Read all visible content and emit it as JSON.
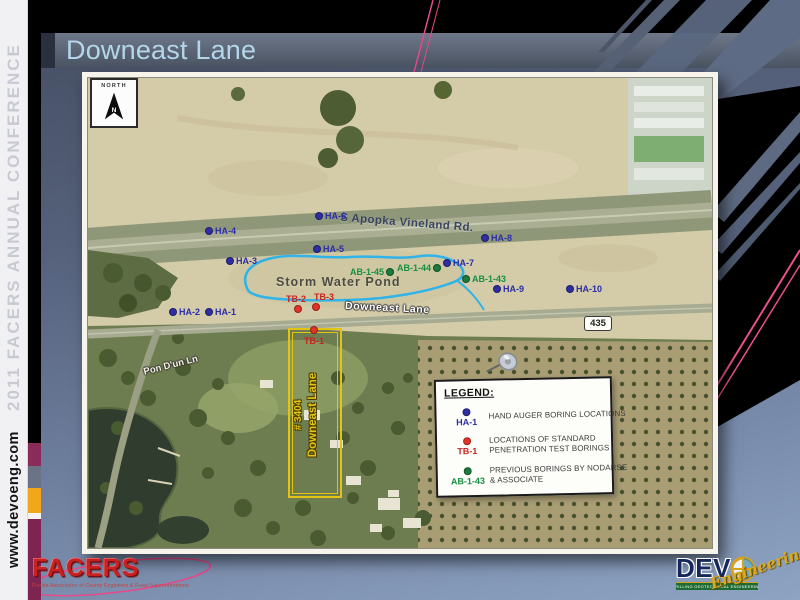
{
  "slide": {
    "title": "Downeast Lane",
    "sidebar_conference": "2011 FACERS ANNUAL CONFERENCE",
    "sidebar_url": "www.devoeng.com"
  },
  "map": {
    "north_label": "NORTH",
    "route_shield": "435",
    "labels": {
      "main_road": "S Apopka Vineland Rd.",
      "storm_pond": "Storm Water Pond",
      "downeast_lane": "Downeast Lane",
      "pon_lane": "Pon D'un Ln",
      "parcel_line1": "# 3404",
      "parcel_line2": "Downeast Lane"
    },
    "markers": [
      {
        "label": "HA-4",
        "type": "ha",
        "x": 121,
        "y": 153,
        "side": "right"
      },
      {
        "label": "HA-6",
        "type": "ha",
        "x": 231,
        "y": 138,
        "side": "right"
      },
      {
        "label": "HA-5",
        "type": "ha",
        "x": 229,
        "y": 171,
        "side": "right"
      },
      {
        "label": "HA-3",
        "type": "ha",
        "x": 142,
        "y": 183,
        "side": "right"
      },
      {
        "label": "HA-2",
        "type": "ha",
        "x": 85,
        "y": 234,
        "side": "right"
      },
      {
        "label": "HA-1",
        "type": "ha",
        "x": 121,
        "y": 234,
        "side": "right"
      },
      {
        "label": "HA-8",
        "type": "ha",
        "x": 397,
        "y": 160,
        "side": "right"
      },
      {
        "label": "HA-7",
        "type": "ha",
        "x": 359,
        "y": 185,
        "side": "right"
      },
      {
        "label": "HA-9",
        "type": "ha",
        "x": 409,
        "y": 211,
        "side": "right"
      },
      {
        "label": "HA-10",
        "type": "ha",
        "x": 482,
        "y": 211,
        "side": "right"
      },
      {
        "label": "AB-1-45",
        "type": "ab",
        "x": 302,
        "y": 194,
        "side": "left"
      },
      {
        "label": "AB-1-44",
        "type": "ab",
        "x": 349,
        "y": 190,
        "side": "left"
      },
      {
        "label": "AB-1-43",
        "type": "ab",
        "x": 378,
        "y": 201,
        "side": "right"
      },
      {
        "label": "TB-2",
        "type": "tb",
        "x": 210,
        "y": 231,
        "side": "aboveLeft"
      },
      {
        "label": "TB-3",
        "type": "tb",
        "x": 228,
        "y": 229,
        "side": "aboveRight"
      },
      {
        "label": "TB-1",
        "type": "tb",
        "x": 226,
        "y": 252,
        "side": "below"
      }
    ]
  },
  "legend": {
    "title": "LEGEND:",
    "items": [
      {
        "key": "HA-1",
        "type": "ha",
        "lines": [
          "HAND AUGER BORING LOCATIONS"
        ]
      },
      {
        "key": "TB-1",
        "type": "tb",
        "lines": [
          "LOCATIONS OF STANDARD",
          "PENETRATION TEST BORINGS"
        ]
      },
      {
        "key": "AB-1-43",
        "type": "ab",
        "lines": [
          "PREVIOUS BORINGS BY NODARSE",
          "& ASSOCIATE"
        ]
      }
    ]
  },
  "footer": {
    "facers_name": "FACERS",
    "facers_tagline": "Florida Association of County Engineers & Road Superintendents",
    "devo_name": "DEV",
    "devo_script": "Engineering",
    "devo_bar": "DRILLING GEOTECHNICAL ENGINEERING"
  },
  "colors": {
    "ha_dot": "#2e2ea2",
    "ha_label": "#2c2ca6",
    "tb_dot": "#e23327",
    "tb_label": "#c8231d",
    "ab_dot": "#1b7a3c",
    "ab_label": "#169043",
    "pond_outline": "#2fb3e8",
    "parcel": "#e3c414",
    "accent_maroon": "#8b2c58",
    "accent_amber": "#f2a71b"
  }
}
